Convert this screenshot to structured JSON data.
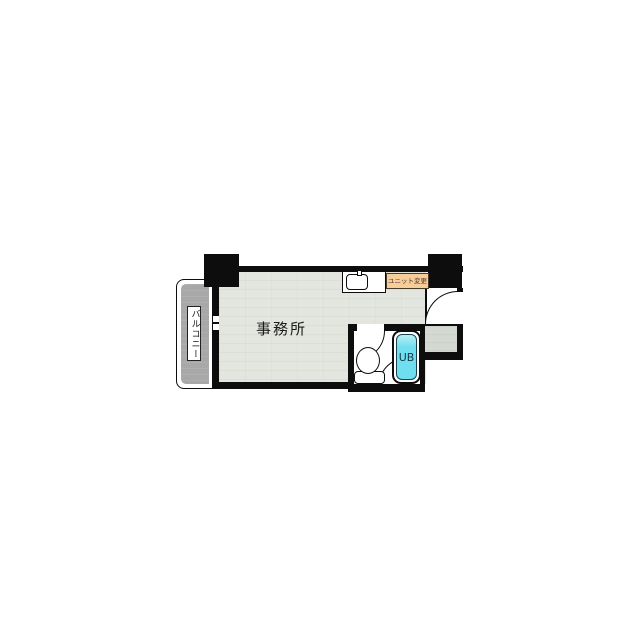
{
  "floorplan": {
    "room_label": "事務所",
    "balcony_label": "バルコニー",
    "bath_label": "UB",
    "note_label": "ユニット変更",
    "colors": {
      "wall": "#0d0d0d",
      "office-floor": "#e2e6df",
      "balcony-floor": "#a8a8a8",
      "entry-floor": "#d3d8d0",
      "note-bg": "#f7cd9a",
      "note-border": "#4a3a28",
      "note-text": "#54382a",
      "tub-fill": "#6fdeee",
      "tub-border": "#17444f",
      "tub-text": "#143845"
    }
  }
}
